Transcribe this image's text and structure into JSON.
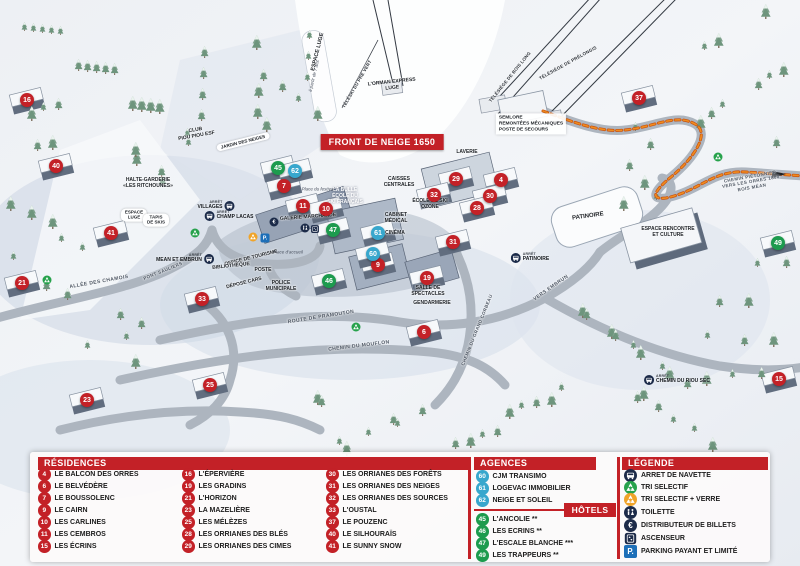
{
  "map": {
    "banner": "FRONT DE NEIGE 1650",
    "arret_word": "ARRÊT",
    "markers": [
      {
        "n": "16",
        "x": 27,
        "y": 100,
        "color": "red"
      },
      {
        "n": "40",
        "x": 56,
        "y": 166,
        "color": "red"
      },
      {
        "n": "41",
        "x": 111,
        "y": 233,
        "color": "red"
      },
      {
        "n": "21",
        "x": 22,
        "y": 283,
        "color": "red"
      },
      {
        "n": "23",
        "x": 87,
        "y": 400,
        "color": "red"
      },
      {
        "n": "25",
        "x": 210,
        "y": 385,
        "color": "red"
      },
      {
        "n": "33",
        "x": 202,
        "y": 299,
        "color": "red"
      },
      {
        "n": "7",
        "x": 284,
        "y": 186,
        "color": "red"
      },
      {
        "n": "11",
        "x": 303,
        "y": 206,
        "color": "red"
      },
      {
        "n": "10",
        "x": 326,
        "y": 209,
        "color": "red"
      },
      {
        "n": "29",
        "x": 456,
        "y": 179,
        "color": "red"
      },
      {
        "n": "32",
        "x": 434,
        "y": 195,
        "color": "red"
      },
      {
        "n": "4",
        "x": 501,
        "y": 180,
        "color": "red"
      },
      {
        "n": "30",
        "x": 490,
        "y": 196,
        "color": "red"
      },
      {
        "n": "28",
        "x": 477,
        "y": 208,
        "color": "red"
      },
      {
        "n": "9",
        "x": 378,
        "y": 265,
        "color": "red"
      },
      {
        "n": "31",
        "x": 453,
        "y": 242,
        "color": "red"
      },
      {
        "n": "19",
        "x": 427,
        "y": 278,
        "color": "red"
      },
      {
        "n": "6",
        "x": 424,
        "y": 332,
        "color": "red"
      },
      {
        "n": "37",
        "x": 639,
        "y": 98,
        "color": "red"
      },
      {
        "n": "15",
        "x": 779,
        "y": 379,
        "color": "red"
      },
      {
        "n": "45",
        "x": 278,
        "y": 168,
        "color": "green"
      },
      {
        "n": "47",
        "x": 333,
        "y": 230,
        "color": "green"
      },
      {
        "n": "46",
        "x": 329,
        "y": 281,
        "color": "green"
      },
      {
        "n": "49",
        "x": 778,
        "y": 243,
        "color": "green"
      },
      {
        "n": "62",
        "x": 295,
        "y": 171,
        "color": "blue"
      },
      {
        "n": "61",
        "x": 378,
        "y": 233,
        "color": "blue"
      },
      {
        "n": "60",
        "x": 373,
        "y": 254,
        "color": "blue"
      }
    ],
    "labels": [
      {
        "lines": [
          "CLUB",
          "PIOU PIOU ESF"
        ],
        "x": 196,
        "y": 133,
        "rot": -10,
        "cls": "poi",
        "size": 5
      },
      {
        "lines": [
          "JARDIN DES NEIGES"
        ],
        "x": 243,
        "y": 142,
        "rot": -14,
        "cls": "pill"
      },
      {
        "lines": [
          "HALTE-GARDERIE",
          "«LES RITCHOUNES»"
        ],
        "x": 148,
        "y": 183,
        "rot": 0,
        "cls": "poi",
        "size": 5
      },
      {
        "lines": [
          "ESPACE",
          "LUGE"
        ],
        "x": 134,
        "y": 215,
        "rot": 0,
        "cls": "pill"
      },
      {
        "lines": [
          "TAPIS",
          "DE SKIS"
        ],
        "x": 156,
        "y": 220,
        "rot": 0,
        "cls": "pill"
      },
      {
        "lines": [
          "ESPACE LUGE"
        ],
        "x": 318,
        "y": 52,
        "rot": -76,
        "cls": "poi",
        "size": 5.5
      },
      {
        "lines": [
          "à partir de 7 ans"
        ],
        "x": 314,
        "y": 76,
        "rot": -76,
        "cls": "place"
      },
      {
        "lines": [
          "TÉLÉSKI DU PRÉ VERT"
        ],
        "x": 357,
        "y": 84,
        "rot": -60,
        "cls": "lift"
      },
      {
        "lines": [
          "L'ORMAN EXPRESS",
          "LUGE"
        ],
        "x": 392,
        "y": 85,
        "rot": -6,
        "cls": "poi",
        "size": 5
      },
      {
        "lines": [
          "TÉLÉSIÈGE DE BOIS LONG"
        ],
        "x": 510,
        "y": 77,
        "rot": -51,
        "cls": "lift"
      },
      {
        "lines": [
          "TÉLÉSIÈGE DE PRÉLONGIS"
        ],
        "x": 568,
        "y": 63,
        "rot": -29,
        "cls": "lift"
      },
      {
        "lines": [
          "SEMLORE",
          "REMONTÉES MÉCANIQUES",
          "POSTE DE SECOURS"
        ],
        "x": 531,
        "y": 124,
        "rot": 0,
        "cls": "boxed",
        "size": 4.8
      },
      {
        "lines": [
          "LAVERIE"
        ],
        "x": 467,
        "y": 152,
        "rot": 0,
        "cls": "poi",
        "size": 5
      },
      {
        "lines": [
          "CAISSES",
          "CENTRALES"
        ],
        "x": 399,
        "y": 182,
        "rot": 0,
        "cls": "poi",
        "size": 5
      },
      {
        "lines": [
          "LA BULLE",
          "ÉCOLE DU",
          "SKI FRANÇAIS"
        ],
        "x": 345,
        "y": 196,
        "rot": 0,
        "cls": "white",
        "size": 5
      },
      {
        "lines": [
          "Place du festival"
        ],
        "x": 318,
        "y": 189,
        "rot": 0,
        "cls": "place"
      },
      {
        "lines": [
          "GALERIE MARCHANDE"
        ],
        "x": 308,
        "y": 217,
        "rot": -4,
        "cls": "poi",
        "size": 5
      },
      {
        "lines": [
          "ÉCOLE DE SKI",
          "OZONE"
        ],
        "x": 430,
        "y": 204,
        "rot": 0,
        "cls": "poi",
        "size": 5
      },
      {
        "lines": [
          "CABINET",
          "MÉDICAL"
        ],
        "x": 396,
        "y": 218,
        "rot": 0,
        "cls": "poi",
        "size": 5
      },
      {
        "lines": [
          "CINÉMA"
        ],
        "x": 395,
        "y": 233,
        "rot": 0,
        "cls": "poi",
        "size": 5
      },
      {
        "lines": [
          "OFFICE DE TOURISME"
        ],
        "x": 251,
        "y": 258,
        "rot": -14,
        "cls": "poi",
        "size": 5
      },
      {
        "lines": [
          "BIBLIOTHÈQUE"
        ],
        "x": 231,
        "y": 266,
        "rot": -6,
        "cls": "poi",
        "size": 5
      },
      {
        "lines": [
          "POSTE"
        ],
        "x": 263,
        "y": 270,
        "rot": 0,
        "cls": "poi",
        "size": 5
      },
      {
        "lines": [
          "Place d'accueil"
        ],
        "x": 288,
        "y": 252,
        "rot": 0,
        "cls": "place"
      },
      {
        "lines": [
          "DÉPOSE CARS"
        ],
        "x": 244,
        "y": 283,
        "rot": -14,
        "cls": "poi",
        "size": 5
      },
      {
        "lines": [
          "POLICE",
          "MUNICIPALE"
        ],
        "x": 281,
        "y": 286,
        "rot": 0,
        "cls": "poi",
        "size": 5
      },
      {
        "lines": [
          "ALLÉE DES CHAMOIS"
        ],
        "x": 99,
        "y": 282,
        "rot": -10,
        "cls": "road"
      },
      {
        "lines": [
          "PONT SAULIERS"
        ],
        "x": 163,
        "y": 271,
        "rot": -22,
        "cls": "road",
        "size": 4.5
      },
      {
        "lines": [
          "ROUTE DE PRAMOUTON"
        ],
        "x": 321,
        "y": 317,
        "rot": -9,
        "cls": "road"
      },
      {
        "lines": [
          "CHEMIN DU MOUFLON"
        ],
        "x": 359,
        "y": 346,
        "rot": -7,
        "cls": "road"
      },
      {
        "lines": [
          "CHEMIN DU GRAND CORBEAU"
        ],
        "x": 477,
        "y": 330,
        "rot": -68,
        "cls": "road",
        "size": 4.5
      },
      {
        "lines": [
          "VERS EMBRUN"
        ],
        "x": 551,
        "y": 288,
        "rot": -35,
        "cls": "road"
      },
      {
        "lines": [
          "SALLE DE",
          "SPECTACLES"
        ],
        "x": 428,
        "y": 291,
        "rot": 0,
        "cls": "poi",
        "size": 5
      },
      {
        "lines": [
          "GENDARMERIE"
        ],
        "x": 432,
        "y": 303,
        "rot": 0,
        "cls": "poi",
        "size": 5
      },
      {
        "lines": [
          "PATINOIRE"
        ],
        "x": 588,
        "y": 217,
        "rot": -8,
        "cls": "poi",
        "size": 6
      },
      {
        "lines": [
          "ESPACE RENCONTRE",
          "ET CULTURE"
        ],
        "x": 668,
        "y": 232,
        "rot": 0,
        "cls": "poi",
        "size": 5
      },
      {
        "lines": [
          "CHEMIN PIÉTONNIER",
          "VERS LES ORRES 1800",
          "BOIS MÉAN"
        ],
        "x": 751,
        "y": 182,
        "rot": -10,
        "cls": "road",
        "size": 4.5
      }
    ],
    "bus_stops": [
      {
        "label": "VILLAGES",
        "x": 216,
        "y": 206,
        "side": "left"
      },
      {
        "label": "CHAMP LACAS",
        "x": 229,
        "y": 216,
        "side": "right"
      },
      {
        "label": "MEAN ET EMBRUN",
        "x": 185,
        "y": 259,
        "side": "left"
      },
      {
        "label": "PATINOIRE",
        "x": 530,
        "y": 258,
        "side": "right"
      },
      {
        "label": "CHEMIN DU RIOU SEC",
        "x": 677,
        "y": 380,
        "side": "right"
      }
    ],
    "icons": [
      {
        "type": "tri-green",
        "x": 47,
        "y": 280
      },
      {
        "type": "tri-green",
        "x": 195,
        "y": 233
      },
      {
        "type": "tri-green",
        "x": 718,
        "y": 157
      },
      {
        "type": "tri-green",
        "x": 356,
        "y": 327
      },
      {
        "type": "tri-orange",
        "x": 253,
        "y": 237
      },
      {
        "type": "parking",
        "x": 265,
        "y": 238
      },
      {
        "type": "euro",
        "x": 274,
        "y": 222
      },
      {
        "type": "wc",
        "x": 305,
        "y": 228
      },
      {
        "type": "ascenseur",
        "x": 315,
        "y": 229
      }
    ]
  },
  "panel": {
    "residences": {
      "title": "RÉSIDENCES",
      "columns": [
        [
          {
            "n": "4",
            "label": "LE BALCON DES ORRES"
          },
          {
            "n": "6",
            "label": "LE BELVÉDÈRE"
          },
          {
            "n": "7",
            "label": "LE BOUSSOLENC"
          },
          {
            "n": "9",
            "label": "LE CAIRN"
          },
          {
            "n": "10",
            "label": "LES CARLINES"
          },
          {
            "n": "11",
            "label": "LES CEMBROS"
          },
          {
            "n": "15",
            "label": "LES ÉCRINS"
          }
        ],
        [
          {
            "n": "16",
            "label": "L'ÉPERVIÈRE"
          },
          {
            "n": "19",
            "label": "LES GRADINS"
          },
          {
            "n": "21",
            "label": "L'HORIZON"
          },
          {
            "n": "23",
            "label": "LA MAZELIÈRE"
          },
          {
            "n": "25",
            "label": "LES MÉLÈZES"
          },
          {
            "n": "28",
            "label": "LES ORRIANES DES BLÉS"
          },
          {
            "n": "29",
            "label": "LES ORRIANES DES CIMES"
          }
        ],
        [
          {
            "n": "30",
            "label": "LES ORRIANES DES FORÊTS"
          },
          {
            "n": "31",
            "label": "LES ORRIANES DES NEIGES"
          },
          {
            "n": "32",
            "label": "LES ORRIANES DES SOURCES"
          },
          {
            "n": "33",
            "label": "L'OUSTAL"
          },
          {
            "n": "37",
            "label": "LE POUZENC"
          },
          {
            "n": "40",
            "label": "LE SILHOURAÏS"
          },
          {
            "n": "41",
            "label": "LE SUNNY SNOW"
          }
        ]
      ]
    },
    "agences": {
      "title": "AGENCES IMMOBILIÈRES",
      "items": [
        {
          "n": "60",
          "label": "CJM TRANSIMO"
        },
        {
          "n": "61",
          "label": "LOGEVAC IMMOBILIER"
        },
        {
          "n": "62",
          "label": "NEIGE ET SOLEIL"
        }
      ]
    },
    "hotels": {
      "title": "HÔTELS",
      "items": [
        {
          "n": "45",
          "label": "L'ANCOLIE **"
        },
        {
          "n": "46",
          "label": "LES ECRINS **"
        },
        {
          "n": "47",
          "label": "L'ESCALE BLANCHE ***"
        },
        {
          "n": "49",
          "label": "LES TRAPPEURS **"
        }
      ]
    },
    "legende": {
      "title": "LÉGENDE",
      "items": [
        {
          "icon": "bus",
          "label": "ARRET DE NAVETTE"
        },
        {
          "icon": "tri-green",
          "label": "TRI SELECTIF"
        },
        {
          "icon": "tri-orange",
          "label": "TRI SELECTIF + VERRE"
        },
        {
          "icon": "wc",
          "label": "TOILETTE"
        },
        {
          "icon": "euro",
          "label": "DISTRIBUTEUR DE BILLETS"
        },
        {
          "icon": "ascenseur",
          "label": "ASCENSEUR"
        },
        {
          "icon": "parking",
          "label": "PARKING PAYANT ET LIMITÉ"
        }
      ]
    }
  },
  "glyphs": {
    "euro": "€",
    "parking": "P."
  },
  "colors": {
    "red": "#c32127",
    "green": "#1d9b4e",
    "blue": "#38a7cd",
    "navy": "#1c2b49",
    "orange": "#f0a429",
    "parking": "#1d6fb8"
  }
}
